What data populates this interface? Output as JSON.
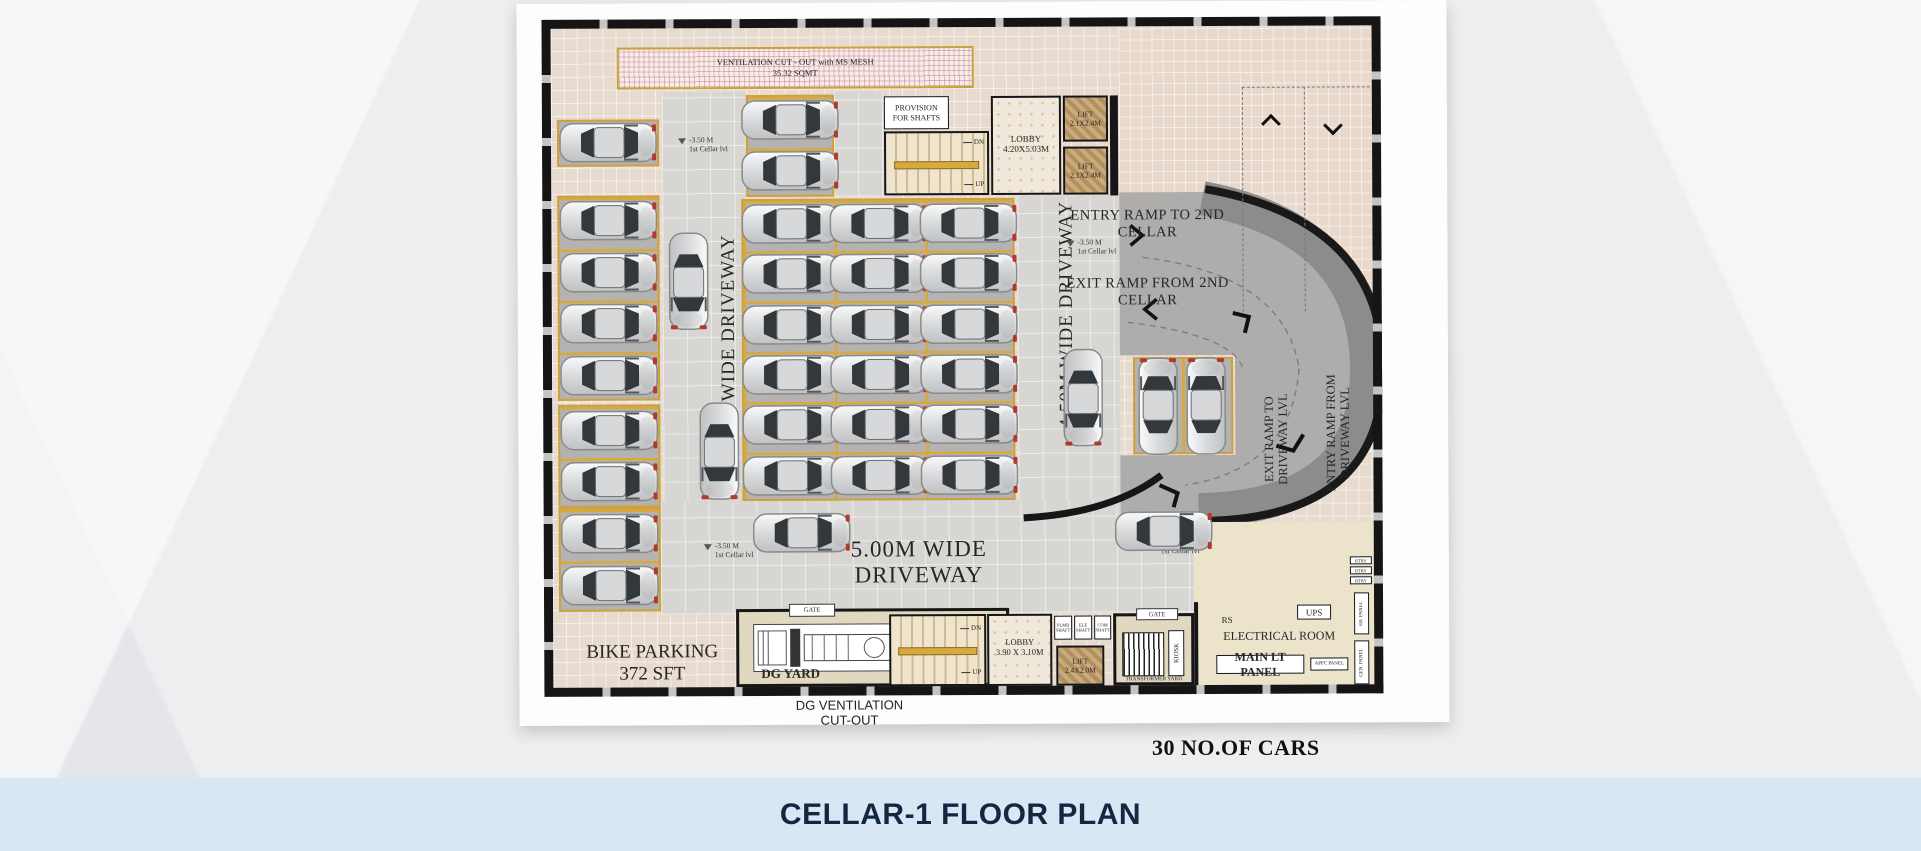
{
  "title_band": {
    "label": "CELLAR-1 FLOOR PLAN"
  },
  "summary": {
    "cars_count": "30 NO.OF CARS"
  },
  "colors": {
    "band": "#d9e6f3",
    "title_text": "#142742",
    "wall": "#161616",
    "stall_gold": "#d8a93c",
    "ramp_mid": "#aeadab",
    "ramp_dark": "#8d8c8a"
  },
  "labels": {
    "ventilation_1": "VENTILATION CUT - OUT with MS MESH",
    "ventilation_2": "35.32 SQMT",
    "provision_1": "PROVISION",
    "provision_2": "FOR SHAFTS",
    "lobby_top_1": "LOBBY",
    "lobby_top_2": "4.20X5.03M",
    "lift_top_1": "LIFT",
    "lift_top_2": "2.1X2.4M",
    "driveway_left": "4.50M WIDE DRIVEWAY",
    "driveway_right": "4.50M WIDE DRIVEWAY",
    "driveway_bottom": "5.00M WIDE DRIVEWAY",
    "entry_ramp_1": "ENTRY RAMP TO 2ND",
    "entry_ramp_2": "CELLAR",
    "exit_ramp_1": "EXIT RAMP FROM 2ND",
    "exit_ramp_2": "CELLAR",
    "exit_ramp_drv_1": "EXIT RAMP TO",
    "exit_ramp_drv_2": "DRIVEWAY LVL",
    "entry_ramp_drv_1": "ENTRY RAMP FROM",
    "entry_ramp_drv_2": "DRIVEWAY LVL",
    "bike_1": "BIKE PARKING",
    "bike_2": "372 SFT",
    "gate": "GATE",
    "dg_yard": "DG YARD",
    "dg_vent_1": "DG VENTILATION",
    "dg_vent_2": "CUT-OUT",
    "lobby_bot_1": "LOBBY",
    "lobby_bot_2": "3.90 X 3.10M",
    "lift_bot_1": "LIFT",
    "lift_bot_2": "2.4X2.0M",
    "shaft_1": "PLMB SHAFT",
    "shaft_2": "ELE SHAFT",
    "shaft_3": "COM SHAFT",
    "transformer_yard": "TRANSFORMER YARD",
    "kiosk": "KIOSK",
    "rs": "RS",
    "ups": "UPS",
    "electrical_room": "ELECTRICAL ROOM",
    "main_lt_panel": "MAIN LT PANEL",
    "apfc_panel": "APFC PANEL",
    "btry": "BTRY",
    "eb_panel": "EB. PANEL",
    "gen_panel": "GEN. PANEL",
    "dn": "DN",
    "up": "UP",
    "level_1": "-3.50 M",
    "level_2": "1st Cellar lvl"
  },
  "cars": {
    "parked_columns": [
      {
        "cx": 66,
        "ys": [
          123,
          201,
          253,
          304,
          356,
          411,
          462,
          514,
          566
        ],
        "rot": 0
      },
      {
        "cx": 248,
        "ys": [
          101,
          152,
          205,
          255,
          306,
          356,
          406,
          457
        ],
        "rot": 0
      },
      {
        "cx": 336,
        "ys": [
          205,
          255,
          306,
          356,
          406,
          457
        ],
        "rot": 0
      },
      {
        "cx": 426,
        "ys": [
          205,
          255,
          306,
          356,
          406,
          457
        ],
        "rot": 0
      }
    ],
    "singles": [
      {
        "x": 615,
        "y": 389,
        "rot": -90
      },
      {
        "x": 663,
        "y": 389,
        "rot": -90
      },
      {
        "x": 146,
        "y": 262,
        "rot": 90
      },
      {
        "x": 176,
        "y": 432,
        "rot": 90
      },
      {
        "x": 258,
        "y": 514,
        "rot": 0
      },
      {
        "x": 620,
        "y": 514,
        "rot": 0
      },
      {
        "x": 540,
        "y": 380,
        "rot": 90
      }
    ]
  },
  "level_markers": [
    {
      "x": 136,
      "y": 116
    },
    {
      "x": 524,
      "y": 220
    },
    {
      "x": 160,
      "y": 522
    },
    {
      "x": 606,
      "y": 520
    }
  ]
}
